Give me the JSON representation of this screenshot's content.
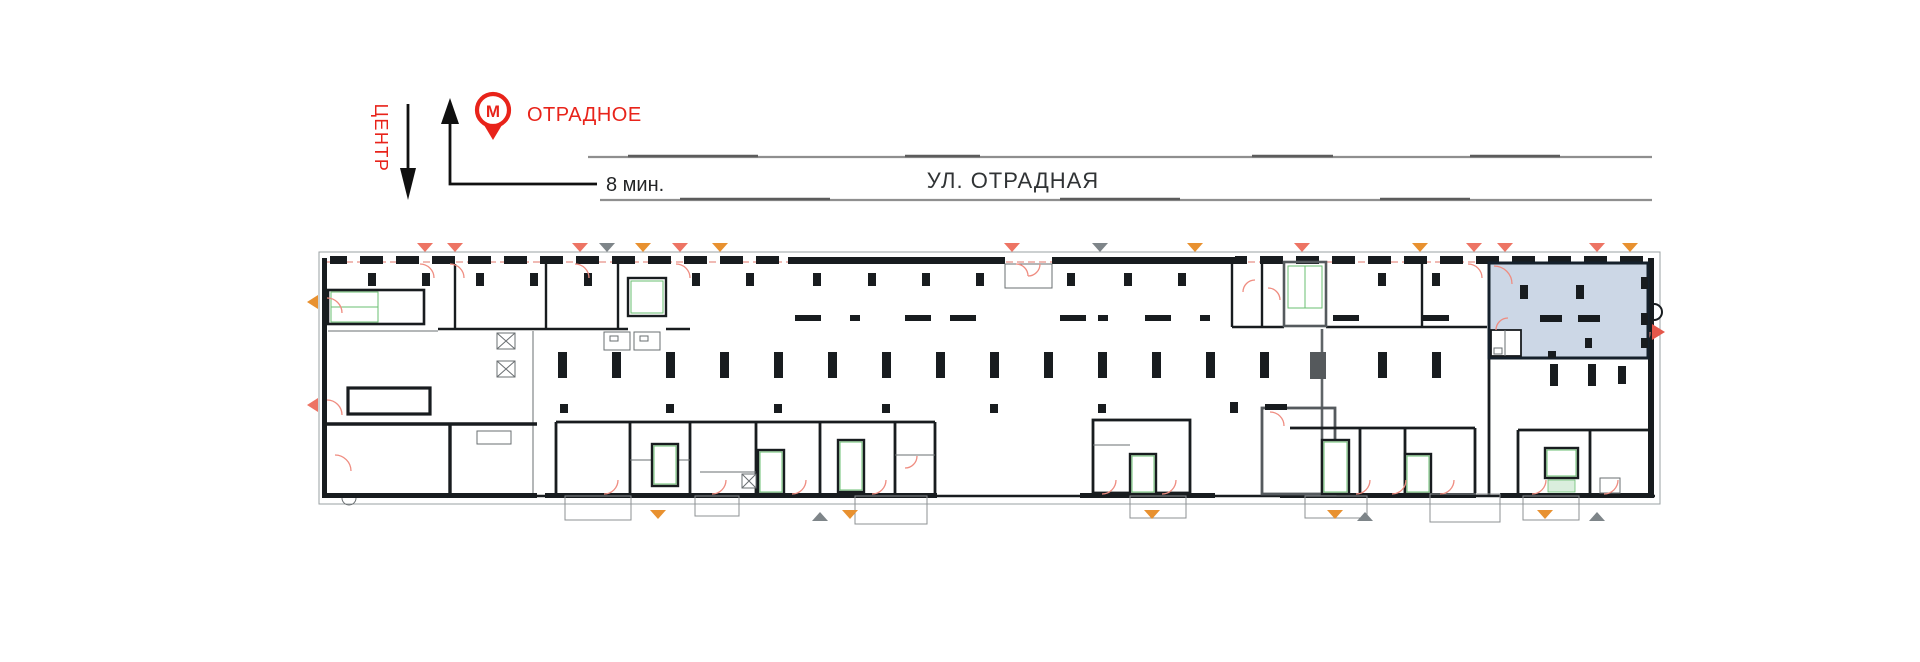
{
  "header": {
    "center_label": "ЦЕНТР",
    "metro": {
      "icon_letter": "М",
      "station_name": "ОТРАДНОЕ",
      "walk_time": "8 мин."
    },
    "street_name": "УЛ. ОТРАДНАЯ"
  },
  "icons": {
    "metro_icon": "red ring pin with letter М",
    "center_direction_arrow": "long arrow pointing down",
    "metro_direction_arrow": "arrow pointing up with leader line to walk time"
  },
  "plan": {
    "highlighted_unit": {
      "state": "selected",
      "position": "right wing, street side"
    }
  },
  "colors": {
    "accent_red": "#e8231a",
    "plan_red": "#ef8c80",
    "plan_red_strong": "#e4574a",
    "dashed_red": "#e0746a",
    "orange_marker": "#e89130",
    "gray_marker": "#7e8589",
    "stair_green": "#6abf70",
    "wall_dark": "#181c1f",
    "street_gray": "#8f8f8f",
    "unit_fill": "#ccd7e6",
    "unit_stroke": "#15202b",
    "text_dark": "#303335"
  }
}
